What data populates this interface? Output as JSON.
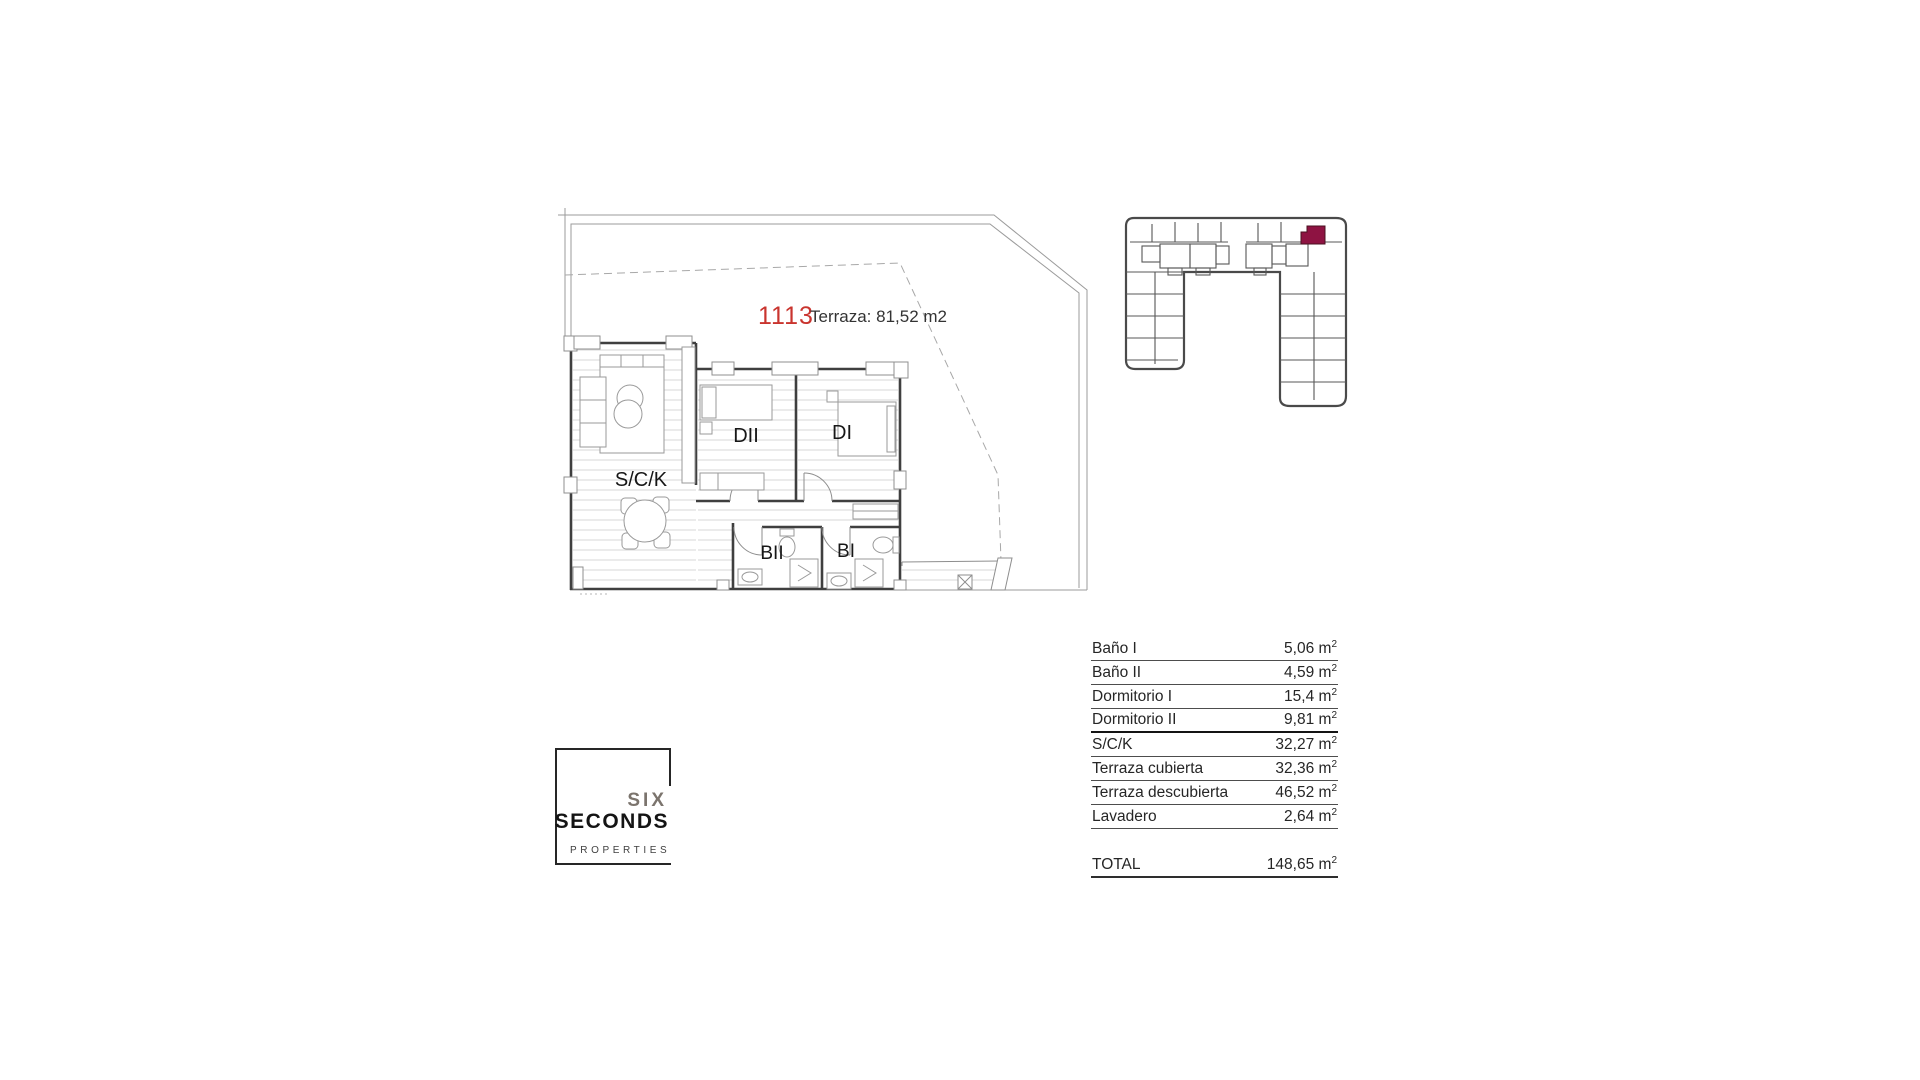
{
  "plan": {
    "unit_number": "1113",
    "terrace_label": "Terraza: 81,52 m2",
    "rooms": {
      "sck": "S/C/K",
      "dormitorio2": "DII",
      "dormitorio1": "DI",
      "bano2": "BII",
      "bano1": "BI"
    }
  },
  "site_plan": {
    "highlight_color": "#8e1342"
  },
  "areas_table": {
    "rows": [
      {
        "label": "Baño I",
        "value": "5,06"
      },
      {
        "label": "Baño II",
        "value": "4,59"
      },
      {
        "label": "Dormitorio I",
        "value": "15,4"
      },
      {
        "label": "Dormitorio II",
        "value": "9,81"
      },
      {
        "label": "S/C/K",
        "value": "32,27"
      },
      {
        "label": "Terraza cubierta",
        "value": "32,36"
      },
      {
        "label": "Terraza descubierta",
        "value": "46,52"
      },
      {
        "label": "Lavadero",
        "value": "2,64"
      }
    ],
    "total": {
      "label": "TOTAL",
      "value": "148,65"
    },
    "unit_base": "m",
    "unit_exponent": "2"
  },
  "logo": {
    "word1": "SIX",
    "word2": "SECONDS",
    "word3": "PROPERTIES"
  },
  "colors": {
    "unit_number": "#c9342e",
    "site_highlight": "#8e1342",
    "wall": "#3f3f3f"
  }
}
